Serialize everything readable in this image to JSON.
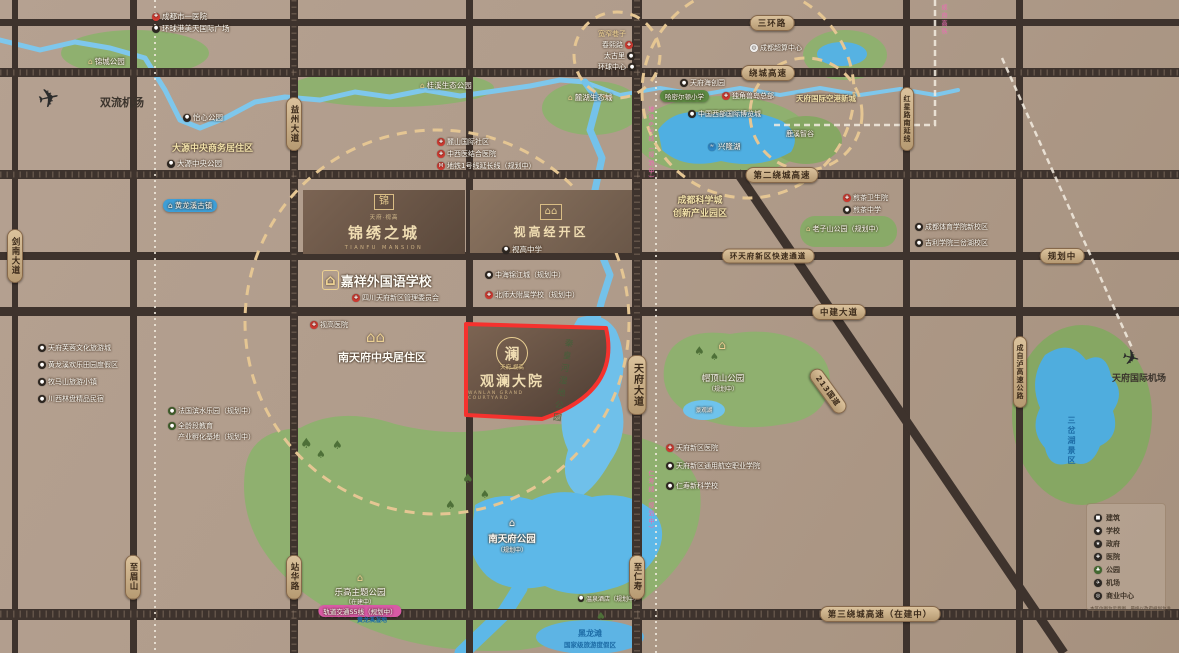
{
  "property": {
    "prefix": "天府·视高",
    "name": "观澜大院",
    "english": "WANLAN GRAND COURTYARD",
    "seal_char": "澜"
  },
  "jinxiu": {
    "prefix": "天府·视高",
    "name": "锦绣之城",
    "english": "TIANFU MANSION",
    "logo_char": "锦"
  },
  "shigao": {
    "name": "视高经开区",
    "school": "视高中学"
  },
  "jiaxiang": {
    "name": "嘉祥外国语学校",
    "sub": "四川天府新区管理委员会"
  },
  "colors": {
    "accent_red": "#f5322e",
    "banner_tan": "#c9ab84",
    "water_blue": "#6fc0ea",
    "park_green": "#8fb06f",
    "metro_pink": "#e963ae"
  },
  "roads": {
    "sanhuanlu": "三环路",
    "raocheng": "绕城高速",
    "dier_raocheng": "第二绕城高速",
    "huantianfu": "环天府新区快速通道",
    "guihuazhong": "规划中",
    "zhongjian": "中建大道",
    "disan_raocheng": "第三绕城高速（在建中）",
    "yizhou": "益州大道",
    "jiannan": "剑南大道",
    "tianfu": "天府大道",
    "hongxing": "红星路南延线",
    "chengzilu": "成自泸高速公路",
    "g213": "213国道",
    "zhimeishan": "至眉山",
    "zhanhua": "站华路",
    "zhirenshou": "至仁寿",
    "chengzi_hsr": "成自高铁",
    "metro6": "地铁6号线（规划中）",
    "renshou_line": "仁寿线（规划中）"
  },
  "pois": {
    "chengdu_hospital": "成都市一医院",
    "huanqiu_plaza": "环球港美天国际广场",
    "jincheng_park": "锦城公园",
    "shuangliu_airport": "双流机场",
    "yixin_park": "怡心公园",
    "dayuan_cbd": "大源中央商务居住区",
    "dayuan_park": "大源中央公园",
    "huanglongxi": "黄龙溪古镇",
    "guixi_park": "桂溪生态公园",
    "luhu_city": "麓湖生态城",
    "xinglong_lake": "兴隆湖",
    "kuanzhai": "宽窄巷子",
    "chunxi": "春熙路",
    "taiguli": "太古里",
    "huanqiu_center": "环球中心",
    "supercomputing": "成都超算中心",
    "haichuang": "天府海创园",
    "hamilton": "哈密尔顿小学",
    "unicorn": "独角兽岛总部",
    "expo_city": "中国西部国际博览城",
    "konggang": "天府国际空港新城",
    "luxi": "鹿溪智谷",
    "science_city_1": "成都科学城",
    "science_city_2": "创新产业园区",
    "lushan": "麓山国际社区",
    "hospital_tcm": "中西医结合医院",
    "metro1": "地铁1号线延长线（规划中）",
    "jiancha_clinic": "煎茶卫生院",
    "jiancha_school": "煎茶中学",
    "sport_college": "成都体育学院新校区",
    "geely": "吉利学院三岔湖校区",
    "laozishan": "老子山公园（规划中）",
    "shigao_hospital": "视高医院",
    "zhonghai": "中海锦江城（规划中）",
    "bnu_school": "北师大附属学校（规划中）",
    "nantianfu_area": "南天府中央居住区",
    "qinhuang": "秦皇河湿地公园",
    "maoding_1": "帽顶山公园",
    "maoding_2": "（规划中）",
    "reservoir": "景观湖",
    "tf_hospital": "天府新区医院",
    "aviation_college": "天府新区通用航空职业学院",
    "xinke_school": "仁寿新科学校",
    "ntf_park": "南天府公园",
    "ntf_sub": "（规划中）",
    "lego": "乐高主题公园",
    "lego_sub": "（在建中）",
    "s5_line": "轨道交通S5线（规划中）",
    "lego_blue": "黄龙溪湿地",
    "spring_hotel": "温泉酒店（规划中）",
    "heilongtan_1": "黑龙滩",
    "heilongtan_2": "国家级旅游度假区",
    "sancha": "三岔湖景区",
    "tianfu_airport": "天府国际机场",
    "fz1": "天府芙蓉文化旅游城",
    "fz2": "黄龙溪欢乐田园度假区",
    "fz3": "牧马山旅游小镇",
    "fz4": "川西林盘精品民宿",
    "fr1": "法国滨水乐园（规划中）",
    "fr2": "全龄段教育",
    "fr3": "产业孵化基地（规划中）"
  },
  "legend": {
    "items": [
      "建筑",
      "学校",
      "政府",
      "医院",
      "公园",
      "机场",
      "商业中心"
    ],
    "note": "本区位图为示意图，最终以政府规划为准"
  }
}
